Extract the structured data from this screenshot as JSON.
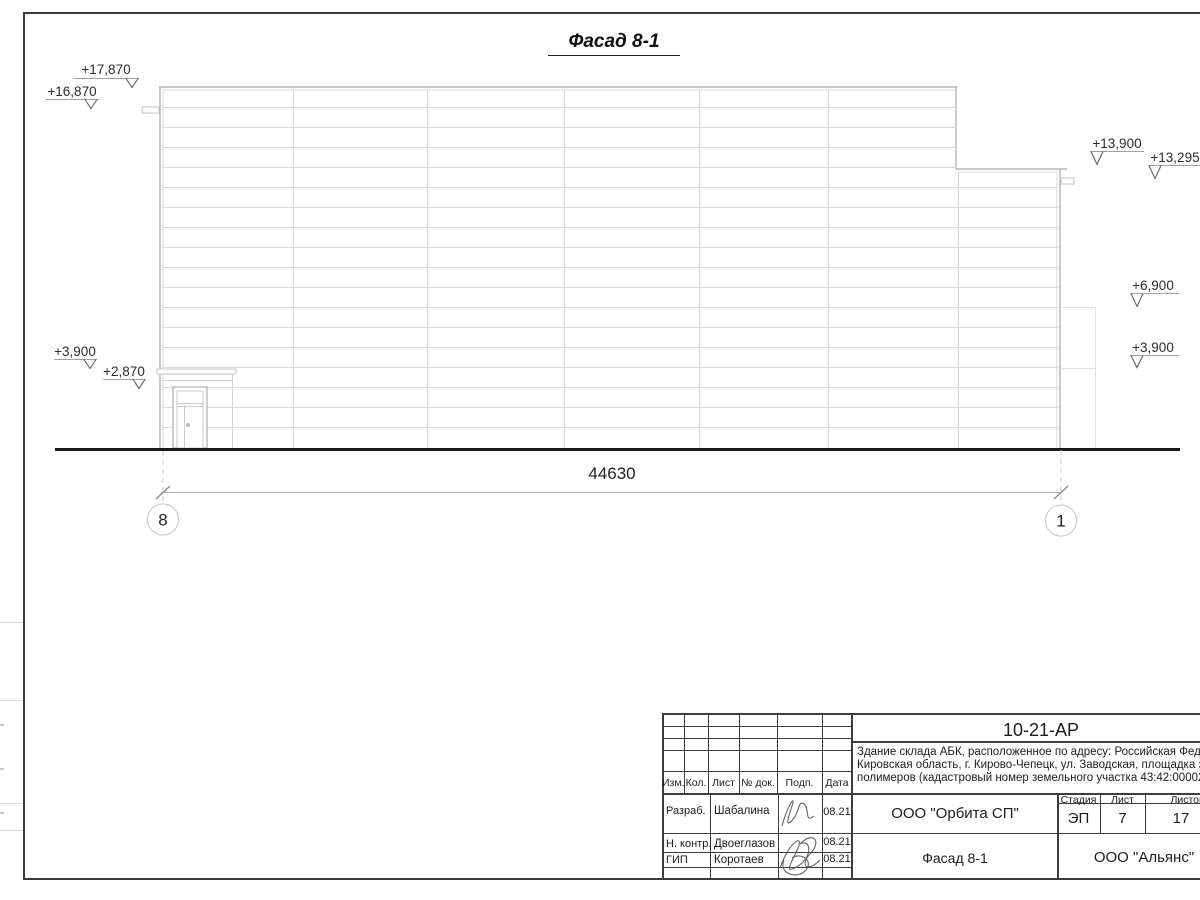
{
  "drawing": {
    "title": "Фасад 8-1",
    "dimension_total": "44630",
    "axes": [
      "8",
      "1"
    ],
    "elevations": {
      "left": [
        "+17,870",
        "+16,870",
        "+3,900",
        "+2,870"
      ],
      "right": [
        "+13,900",
        "+13,295",
        "+6,900",
        "+3,900"
      ]
    }
  },
  "title_block": {
    "doc_number": "10-21-АР",
    "description_lines": [
      "Здание склада АБК, расположенное по адресу: Российская Федерац",
      "Кировская область, г. Кирово-Чепецк, ул. Заводская, площадка заво",
      "полимеров (кадастровый номер земельного участка 43:42:000022:"
    ],
    "header_cols": [
      "Изм.",
      "Кол.",
      "Лист",
      "№ док.",
      "Подп.",
      "Дата"
    ],
    "signature_rows": [
      {
        "role": "Разраб.",
        "name": "Шабалина",
        "date": "08.21"
      },
      {
        "role": "Н. контр.",
        "name": "Двоеглазов",
        "date": "08.21"
      },
      {
        "role": "ГИП",
        "name": "Коротаев",
        "date": "08.21"
      }
    ],
    "design_org": "ООО \"Орбита СП\"",
    "sheet_title": "Фасад 8-1",
    "client_org": "ООО \"Альянс\"",
    "stage_header": [
      "Стадия",
      "Лист",
      "Листов"
    ],
    "stage": "ЭП",
    "sheet_no": "7",
    "sheets_total": "17"
  }
}
